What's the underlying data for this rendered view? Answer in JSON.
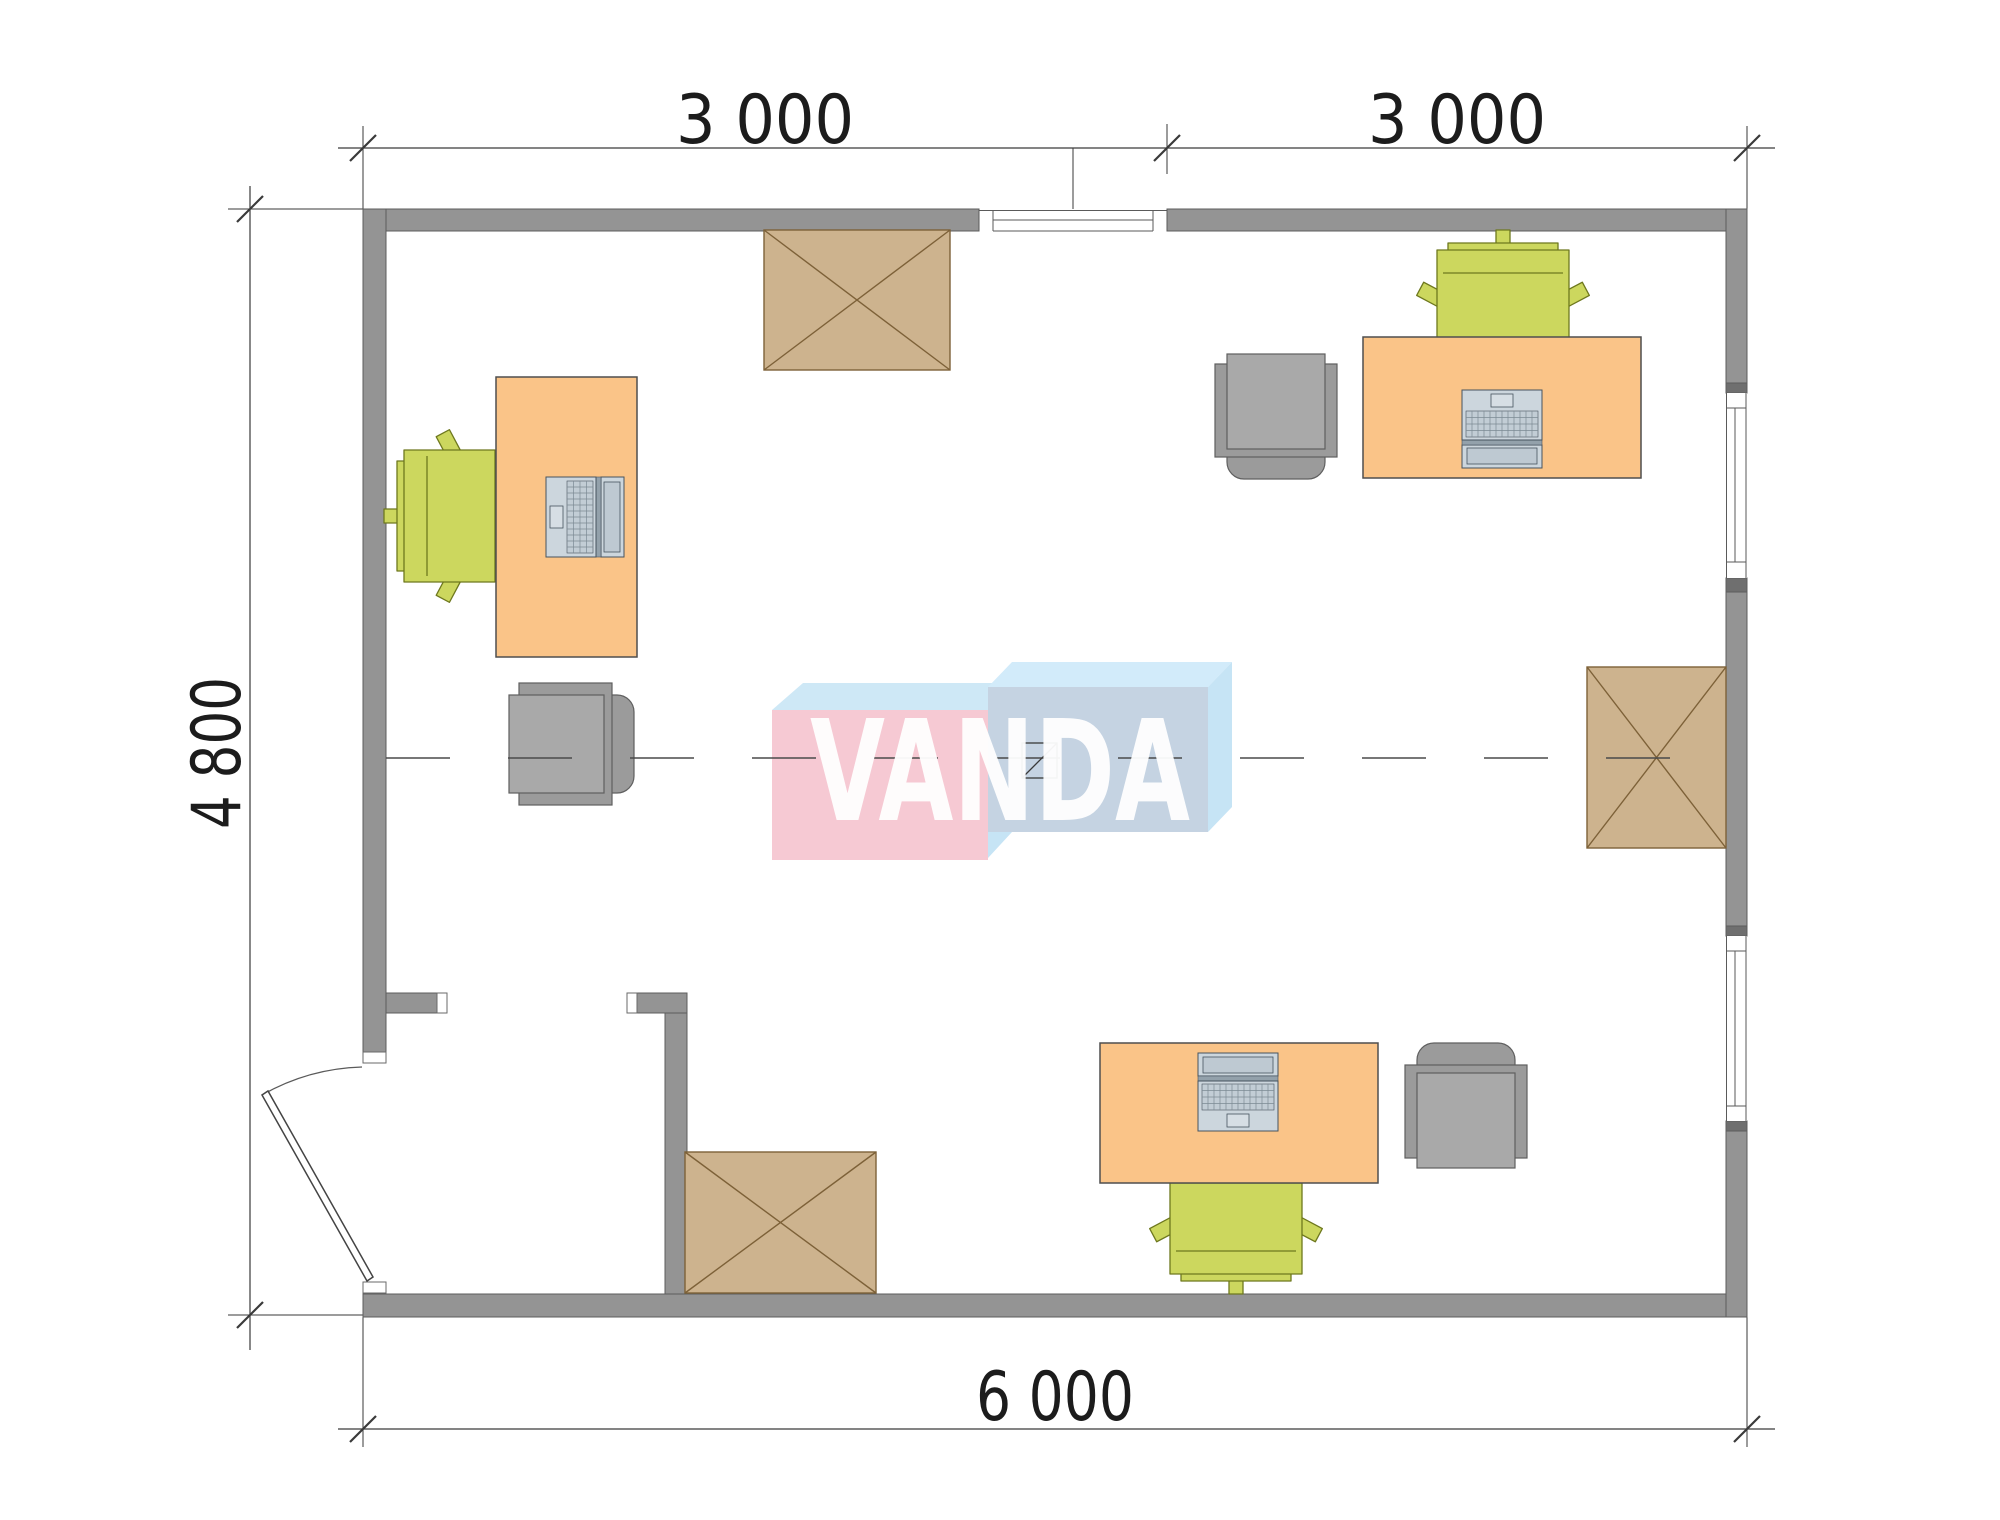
{
  "plan": {
    "dimensions": {
      "top_left": "3 000",
      "top_right": "3 000",
      "left": "4 800",
      "bottom": "6 000"
    },
    "logo_text": "VANDA",
    "colors": {
      "wall": "#949494",
      "desk": "#fac488",
      "chair_green": "#ccd75e",
      "chair_gray": "#9b9b9b",
      "box_brown": "#cdb38e",
      "box_line": "#7d6138",
      "axis": "#4a4a4a",
      "logo_pink": "#f6c9d3",
      "logo_pink_top": "#cee8f6",
      "logo_blue_front": "#c5d3e2",
      "logo_blue_top": "#d2ebfa",
      "logo_blue_side": "#c6e4f5"
    }
  }
}
